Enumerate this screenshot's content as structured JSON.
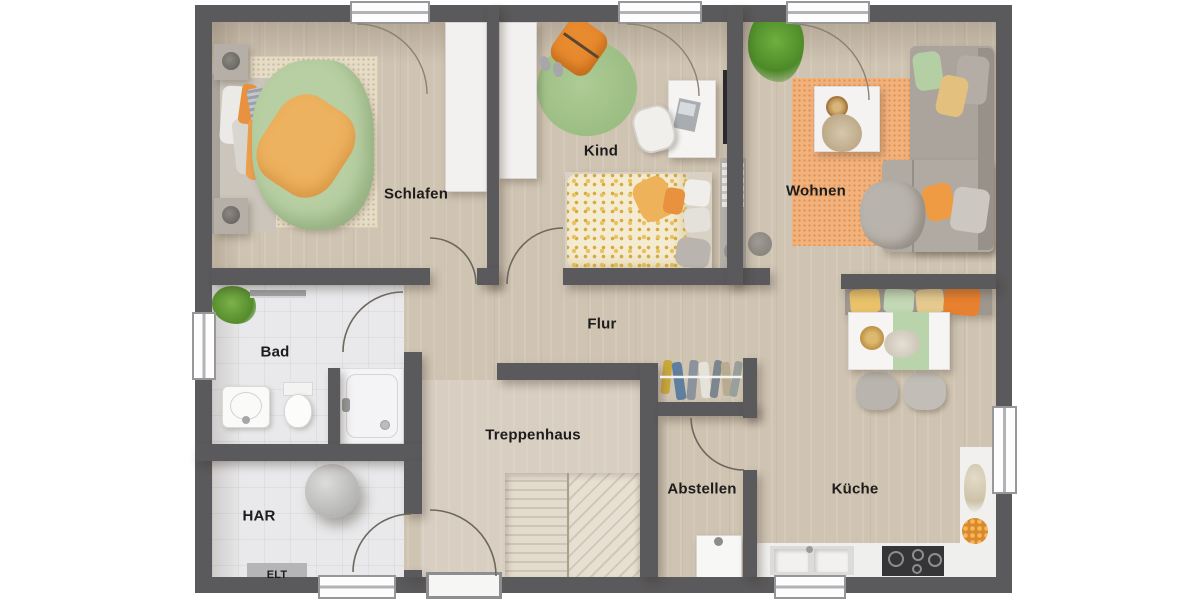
{
  "rooms": {
    "schlafen": "Schlafen",
    "kind": "Kind",
    "wohnen": "Wohnen",
    "bad": "Bad",
    "flur": "Flur",
    "treppenhaus": "Treppenhaus",
    "abstellen": "Abstellen",
    "kueche": "Küche",
    "har": "HAR",
    "elt": "ELT"
  },
  "colors": {
    "wall": "#5a595b",
    "wood_floor": "#cfc3b2",
    "tile_floor": "#e9e9eb",
    "stair_floor": "#d8cec1",
    "accent_orange": "#e8923f",
    "accent_green": "#b7cfa2",
    "rug_orange": "#f2b27e",
    "label_text": "#1c1c1c",
    "window_frame": "#fdfdfd"
  }
}
